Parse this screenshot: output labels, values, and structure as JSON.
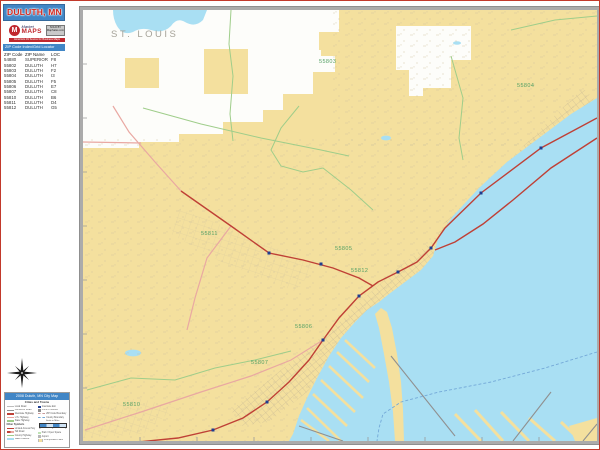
{
  "page": {
    "title": "DULUTH, MN"
  },
  "logo": {
    "mark": "M",
    "brand_top": "Market",
    "brand_main": "MAPS",
    "badge_line1": "SOLD BY",
    "badge_line2": "MapSales.com",
    "tagline": "America's #1 Source for Business Maps"
  },
  "zip_index": {
    "title": "ZIP Code Index/Grid Locator",
    "columns": [
      "ZIP Code",
      "ZIP Name",
      "LOC"
    ],
    "rows": [
      [
        "54880",
        "SUPERIOR",
        "F8"
      ],
      [
        "55802",
        "DULUTH",
        "H7"
      ],
      [
        "55803",
        "DULUTH",
        "F2"
      ],
      [
        "55804",
        "DULUTH",
        "I3"
      ],
      [
        "55805",
        "DULUTH",
        "F5"
      ],
      [
        "55806",
        "DULUTH",
        "E7"
      ],
      [
        "55807",
        "DULUTH",
        "C8"
      ],
      [
        "55810",
        "DULUTH",
        "B6"
      ],
      [
        "55811",
        "DULUTH",
        "D4"
      ],
      [
        "55812",
        "DULUTH",
        "G5"
      ]
    ]
  },
  "map": {
    "county_label": "ST. LOUIS",
    "zip_labels": [
      {
        "code": "55803"
      },
      {
        "code": "55804"
      },
      {
        "code": "55811"
      },
      {
        "code": "55805"
      },
      {
        "code": "55812"
      },
      {
        "code": "55806"
      },
      {
        "code": "55807"
      },
      {
        "code": "55810"
      }
    ],
    "colors": {
      "land": "#F4E09E",
      "water": "#A9DFF3",
      "unincorporated": "#FDFDFA",
      "highway_red": "#BF4036",
      "road_pink": "#E9A8A2",
      "road_green": "#9FCD8A",
      "street_gray": "#C2B493",
      "exit_marker_navy": "#1F3D8F",
      "frame_gray": "#ABABAB",
      "header_blue": "#4186C6",
      "title_red": "#D3281E",
      "zip_label_green": "#54A065",
      "county_label_gray": "#A6A399"
    }
  },
  "legend": {
    "title": "2008 Duluth, MN City Map",
    "subtitle": "Cities and Towns",
    "other_header": "Other Symbols",
    "left_items": [
      "Local Road",
      "Connector Road",
      "Interstate Highway",
      "U.S. Highway",
      "State Highway"
    ],
    "other_items": [
      "Limited Access Hwy",
      "Toll Road",
      "County Highway",
      "Water Feature"
    ],
    "right_items": [
      "Interstate Exit",
      "Point of Interest",
      "ZIP Code Boundary",
      "County Boundary"
    ],
    "right_items2": [
      "Park / Open Space",
      "Airport",
      "Incorporated Place"
    ],
    "scale_label": "Scale in Miles",
    "scale_ticks": [
      "0",
      "1",
      "2"
    ]
  }
}
